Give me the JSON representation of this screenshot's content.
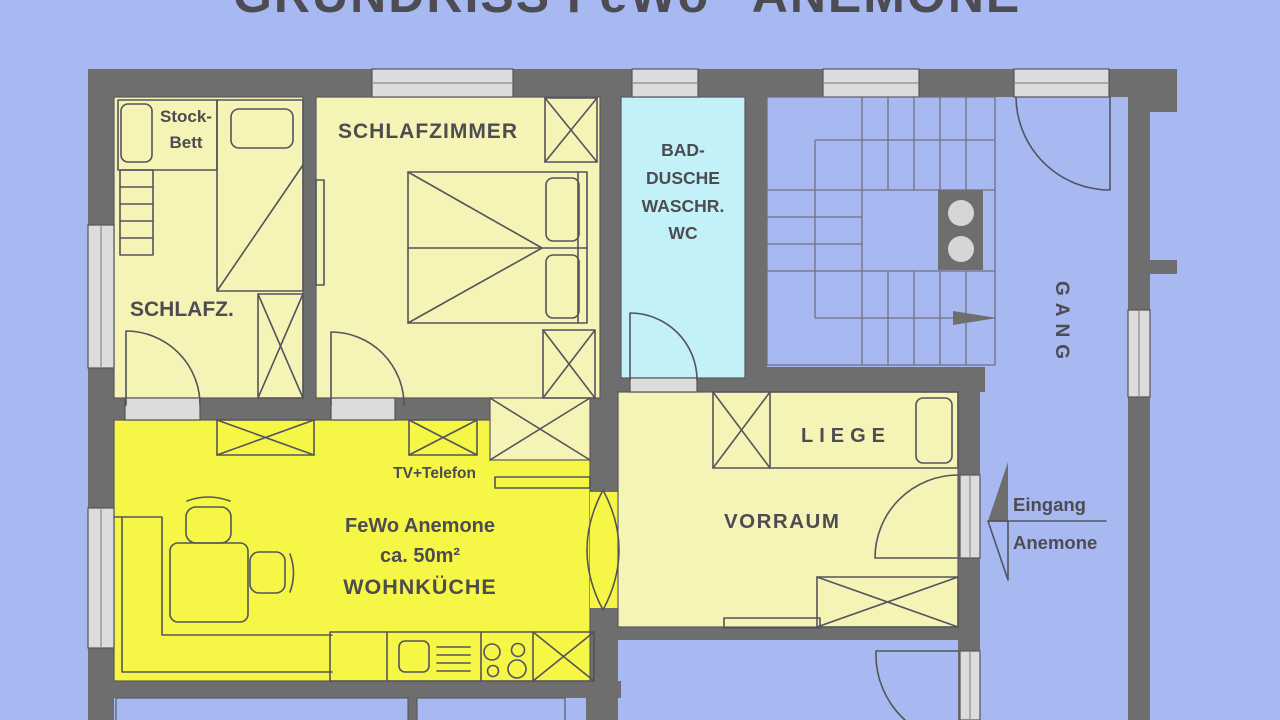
{
  "title": "GRUNDRISS FeWo \"ANEMONE\"",
  "rooms": {
    "schlafz": {
      "label": "SCHLAFZ."
    },
    "stockbett": {
      "line1": "Stock-",
      "line2": "Bett"
    },
    "schlafzimmer": {
      "label": "SCHLAFZIMMER"
    },
    "bad": {
      "line1": "BAD-",
      "line2": "DUSCHE",
      "line3": "WASCHR.",
      "line4": "WC"
    },
    "gang": {
      "label": "GANG"
    },
    "liege": {
      "label": "LIEGE"
    },
    "vorraum": {
      "label": "VORRAUM"
    },
    "wohnkueche": {
      "line1": "FeWo Anemone",
      "line2": "ca. 50m²",
      "line3": "WOHNKÜCHE",
      "tv_label": "TV+Telefon"
    }
  },
  "entrance": {
    "line1": "Eingang",
    "line2": "Anemone"
  },
  "colors": {
    "background": "#a8b9f2",
    "wall": "#6e6e6e",
    "window": "#dcdcdc",
    "room_pale": "#f6f3b7",
    "room_bright": "#f6f646",
    "room_bath": "#c2f1f7",
    "text": "#4c4c52",
    "circle": "#d6d6d6"
  }
}
